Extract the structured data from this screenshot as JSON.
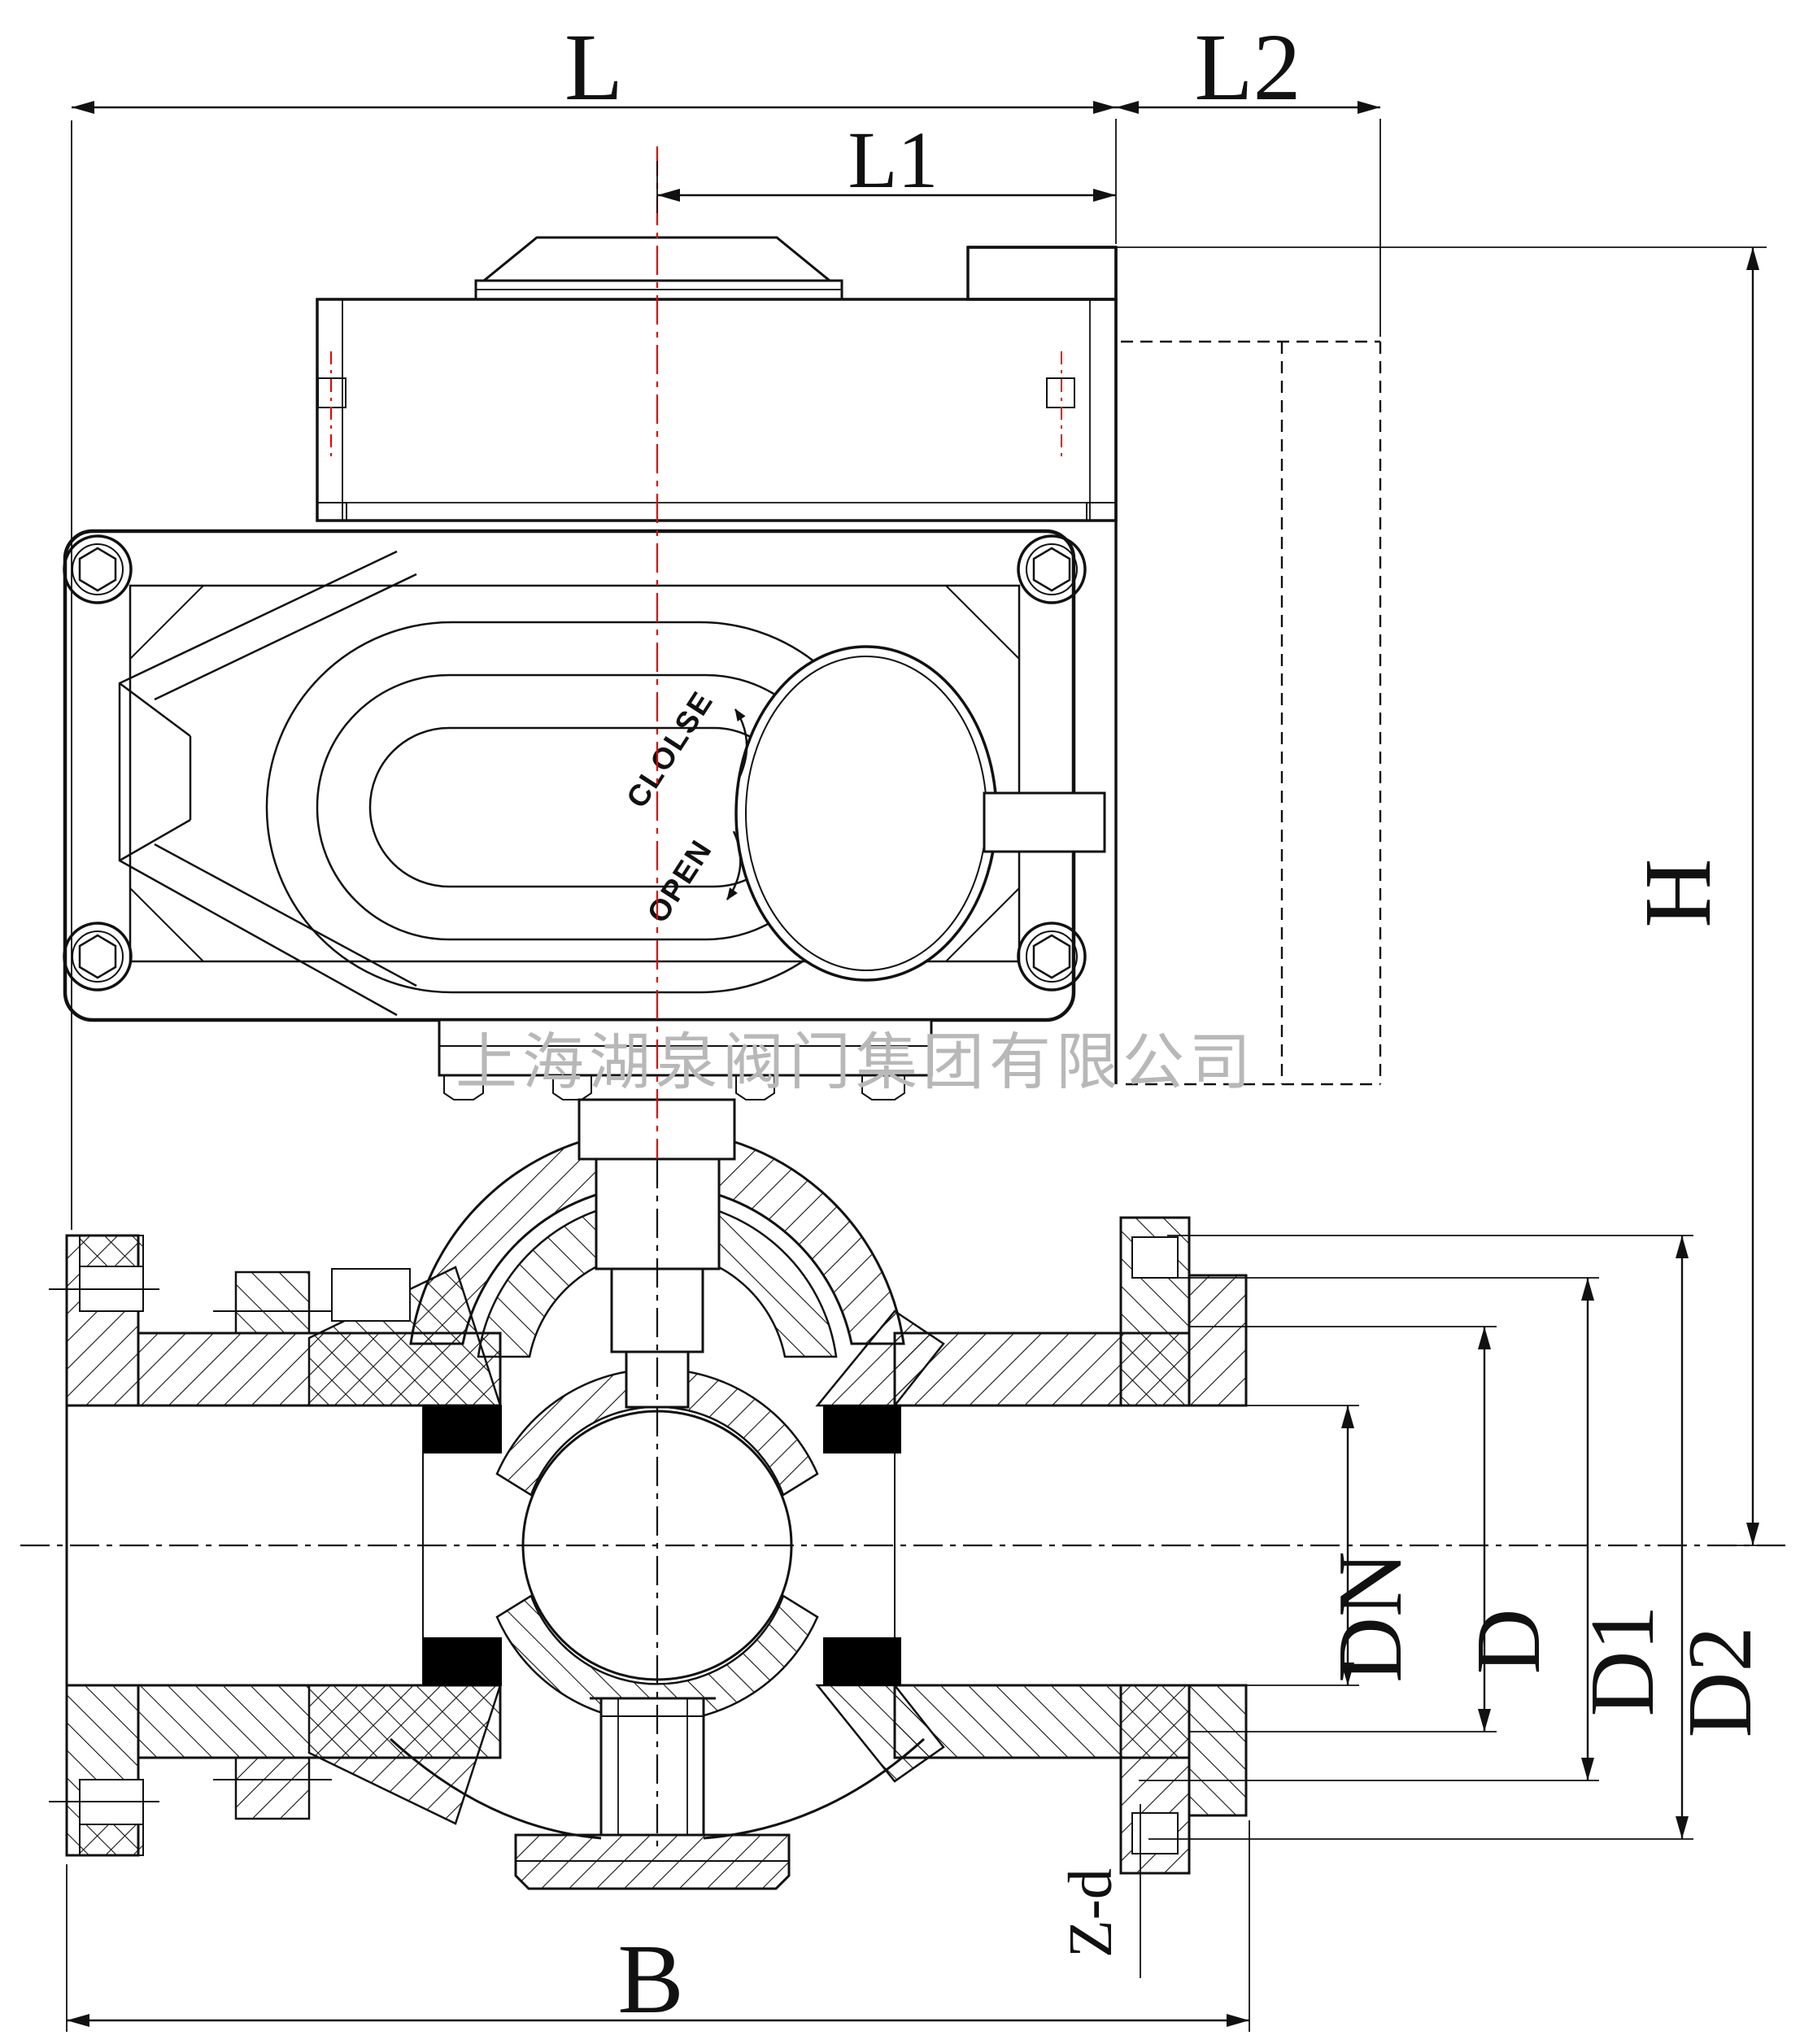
{
  "drawing_type": "valve-engineering-drawing",
  "watermark": "上海湖泉阀门集团有限公司",
  "dimensions": {
    "L": "L",
    "L1": "L1",
    "L2": "L2",
    "H": "H",
    "DN": "DN",
    "D": "D",
    "D1": "D1",
    "D2": "D2",
    "B": "B",
    "Zd": "Z-d"
  },
  "actuator": {
    "close_label": "CLOLSE",
    "open_label": "OPEN"
  },
  "colors": {
    "line": "#111111",
    "centerline_red": "#e60000",
    "watermark_gray": "#b8b8b8",
    "seat_black": "#000000",
    "paper": "#ffffff"
  }
}
